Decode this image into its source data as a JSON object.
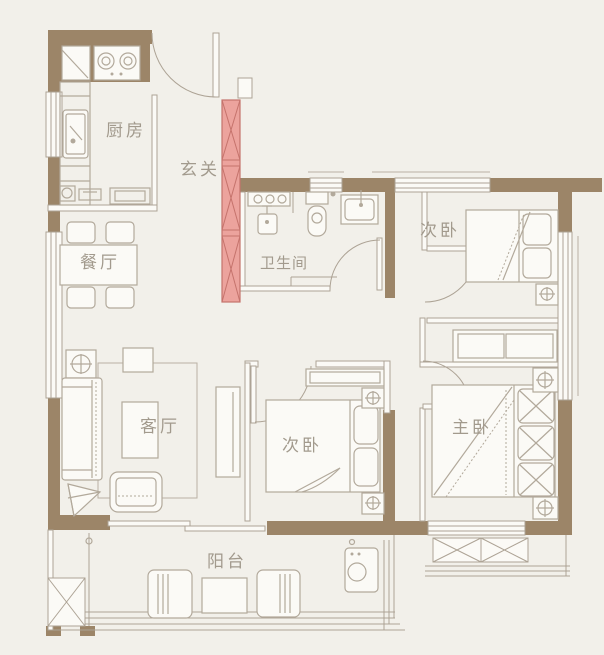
{
  "plan": {
    "type": "apartment-floor-plan",
    "rooms": [
      {
        "id": "kitchen",
        "label": "厨房"
      },
      {
        "id": "entry",
        "label": "玄关"
      },
      {
        "id": "dining",
        "label": "餐厅"
      },
      {
        "id": "bathroom",
        "label": "卫生间"
      },
      {
        "id": "bedroom-north",
        "label": "次卧"
      },
      {
        "id": "living",
        "label": "客厅"
      },
      {
        "id": "bedroom-middle",
        "label": "次卧"
      },
      {
        "id": "master",
        "label": "主卧"
      },
      {
        "id": "balcony",
        "label": "阳台"
      }
    ],
    "highlighted_wall": {
      "room": "玄关",
      "fill": "#eca39d",
      "stroke": "#c5736c"
    },
    "colors": {
      "background": "#f2f0ea",
      "wall": "#9c8568",
      "line": "#ada395",
      "furniture_line": "#b2a99b",
      "label_text": "#a29a8d"
    }
  }
}
